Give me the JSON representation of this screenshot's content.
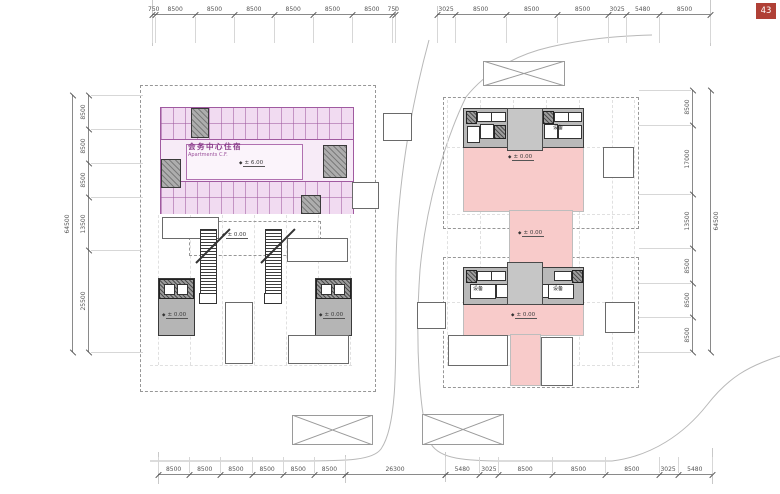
{
  "page": {
    "badge": "43"
  },
  "glyphs": {
    "level_marker": "◆"
  },
  "labels": {
    "level_zero": "± 0.00",
    "equipment": "设备"
  },
  "left_building": {
    "title_cn": "会务中心住宿",
    "title_en": "Apartments C.F.",
    "level": "± 6.00"
  },
  "dims": {
    "top_left": [
      "750",
      "8500",
      "8500",
      "8500",
      "8500",
      "8500",
      "8500",
      "750"
    ],
    "top_right": [
      "3025",
      "8500",
      "8500",
      "8500",
      "3025",
      "5480",
      "8500"
    ],
    "bottom_left": [
      "8500",
      "8500",
      "8500",
      "8500",
      "8500",
      "8500"
    ],
    "bottom_mid": [
      "26300"
    ],
    "bottom_right": [
      "5480",
      "3025",
      "8500",
      "8500",
      "8500",
      "3025",
      "5480"
    ],
    "left_inner": [
      "8500",
      "8500",
      "8500",
      "13500",
      "25500"
    ],
    "left_total": [
      "64500"
    ],
    "right_inner": [
      "8500",
      "17000",
      "13500",
      "8500",
      "8500",
      "8500"
    ],
    "right_total": [
      "64500"
    ]
  }
}
